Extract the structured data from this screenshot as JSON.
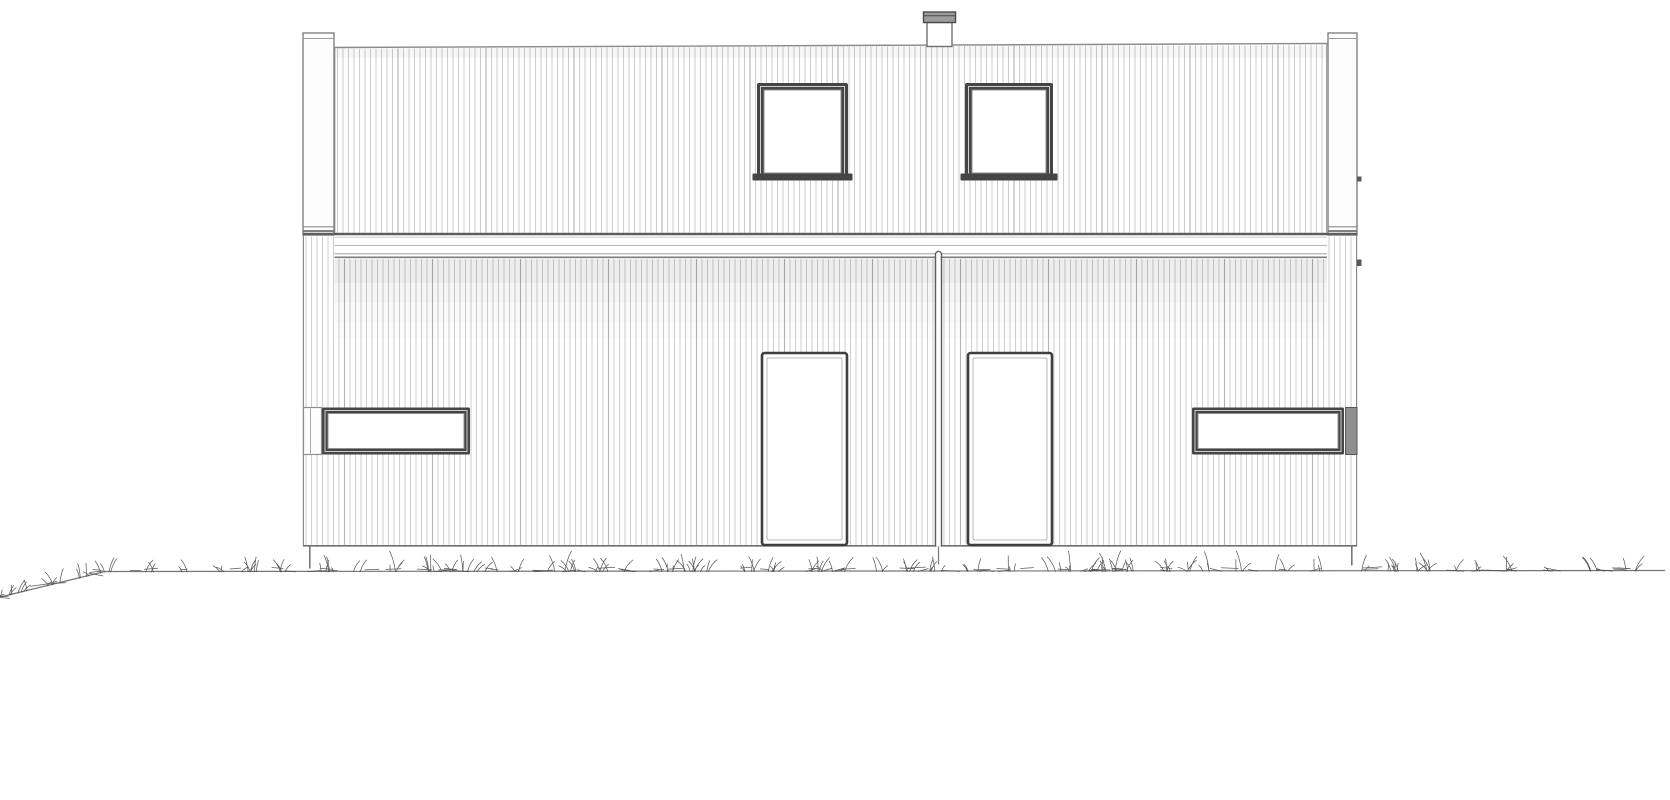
{
  "page": {
    "title": "house-front-elevation-drawing",
    "background": "#ffffff"
  },
  "drawing": {
    "canvas": {
      "w": 1670,
      "h": 800
    },
    "colors": {
      "paper": "#ffffff",
      "outline": "#8a8a8a",
      "outline_dark": "#5e5e5e",
      "outline_mid": "#6f6f6f",
      "cladding_line": "#c9c9c9",
      "cladding_joint": "#b2b2b2",
      "band_line_thin": "#b4b4b4",
      "band_line_low1": "#a0a0a0",
      "band_line_low2": "#7c7c7c",
      "frame_dark": "#3f3f3f",
      "frame_fill_dark": "#454545",
      "frame_inner_light": "#cfcfcf",
      "glass": "#ffffff",
      "post_fill": "#fdfdfd",
      "post_stroke": "#787878",
      "chimney_cap_fill": "#9c9c9c",
      "chimney_cap_stroke": "#4a4a4a",
      "end_block_fill": "#8f8f8f",
      "end_block_stroke": "#565656",
      "divider": "#5c5c5c",
      "ground": "#757575",
      "grass": "#4a4a4a",
      "shadow": "#000000"
    },
    "cladding": {
      "spacing": 5.5,
      "line_width": 0.9,
      "joint_every": 16,
      "joint_width": 1.1
    },
    "upper_wall": {
      "x1": 334.5,
      "x2": 1327,
      "y_top_left": 47.5,
      "y_top_right": 43.5,
      "y_bottom": 232.5,
      "stripe_margin": 3
    },
    "top_shade": {
      "y": 46,
      "h": 12,
      "opacity": 0.03
    },
    "band": {
      "x1": 334.5,
      "x2": 1327,
      "full_x1": 303,
      "full_x2": 1357,
      "rect_y": 233,
      "rect_h": 26,
      "line_top_y": 234,
      "line_top_w": 2.6,
      "line_mid_y": 245.5,
      "line_low1_y": 253.8,
      "line_low2_y": 257.3
    },
    "lower_wall": {
      "x1": 303,
      "x2": 1357,
      "y_top": 235,
      "stripe_y": 236.5,
      "y_bottom": 545.5
    },
    "shadow_steps": [
      {
        "dy": 0,
        "h": 24,
        "o": 0.065
      },
      {
        "dy": 24,
        "h": 20,
        "o": 0.04
      },
      {
        "dy": 44,
        "h": 20,
        "o": 0.022
      },
      {
        "dy": 64,
        "h": 16,
        "o": 0.01
      }
    ],
    "posts": [
      {
        "id": "corner-post-left",
        "x": 303,
        "w": 31
      },
      {
        "id": "corner-post-right",
        "x": 1328,
        "w": 29
      }
    ],
    "post_geom": {
      "y": 33,
      "h": 202,
      "top_inner_y": 38.5,
      "cap_y1": 226.8,
      "cap_y2": 231
    },
    "chimney": {
      "stack": {
        "x": 927,
        "y": 22.5,
        "w": 25,
        "h": 24
      },
      "cap": {
        "x": 923.5,
        "y": 12,
        "w": 32,
        "h": 10.5,
        "line_y": 15.8
      }
    },
    "upper_windows": [
      {
        "id": "upper-window-1",
        "x": 757,
        "y": 83,
        "w": 91,
        "h": 97
      },
      {
        "id": "upper-window-2",
        "x": 965,
        "y": 83,
        "w": 88,
        "h": 97
      }
    ],
    "upper_window_geom": {
      "frame": 7,
      "light_inset": 3.5,
      "sill_dx": 4.5,
      "sill_h": 7,
      "sill_drop": 6.5
    },
    "doors": [
      {
        "id": "door-1",
        "x": 762,
        "w": 85
      },
      {
        "id": "door-2",
        "x": 968,
        "w": 84
      }
    ],
    "door_geom": {
      "y": 353,
      "h": 192,
      "inner_inset": 5
    },
    "ribbon_windows": {
      "y": 407.5,
      "h": 47,
      "frame": 6,
      "light_inset": 3,
      "left_cap": {
        "x": 303.5,
        "w": 18,
        "mid_x": 310.5
      },
      "left_main": {
        "x": 322,
        "w": 148
      },
      "right_main": {
        "x": 1192,
        "w": 152
      },
      "right_block": {
        "x": 1345.5,
        "w": 11.5
      }
    },
    "divider": {
      "x1": 935.5,
      "x2": 941.5,
      "y1": 251.5,
      "y2": 546.5,
      "stub_y2": 564.5
    },
    "brackets": [
      {
        "x": 1357,
        "y": 176.5,
        "w": 4.5,
        "h": 5
      },
      {
        "x": 1357,
        "y": 259.5,
        "w": 4.5,
        "h": 6.5
      }
    ],
    "stubs": [
      {
        "x": 309.8,
        "y1": 546,
        "y2": 568.5
      },
      {
        "x": 1351.8,
        "y1": 546,
        "y2": 565.5
      }
    ],
    "ground": {
      "pts": [
        [
          0,
          597
        ],
        [
          105,
          571.5
        ],
        [
          1665,
          570.5
        ]
      ]
    },
    "grass": {
      "seed": 987123,
      "x_start": 4,
      "x_end": 1660,
      "step_min": 15,
      "step_max": 47,
      "blades_min": 3,
      "blades_max": 8,
      "spread": 8,
      "height_min": 4,
      "height_max": 15,
      "tall_chance": 0.18,
      "tall_extra": 6,
      "lean": 9,
      "fallen_chance": 0.27,
      "stroke_width": 0.75,
      "opacity": 0.9
    }
  }
}
